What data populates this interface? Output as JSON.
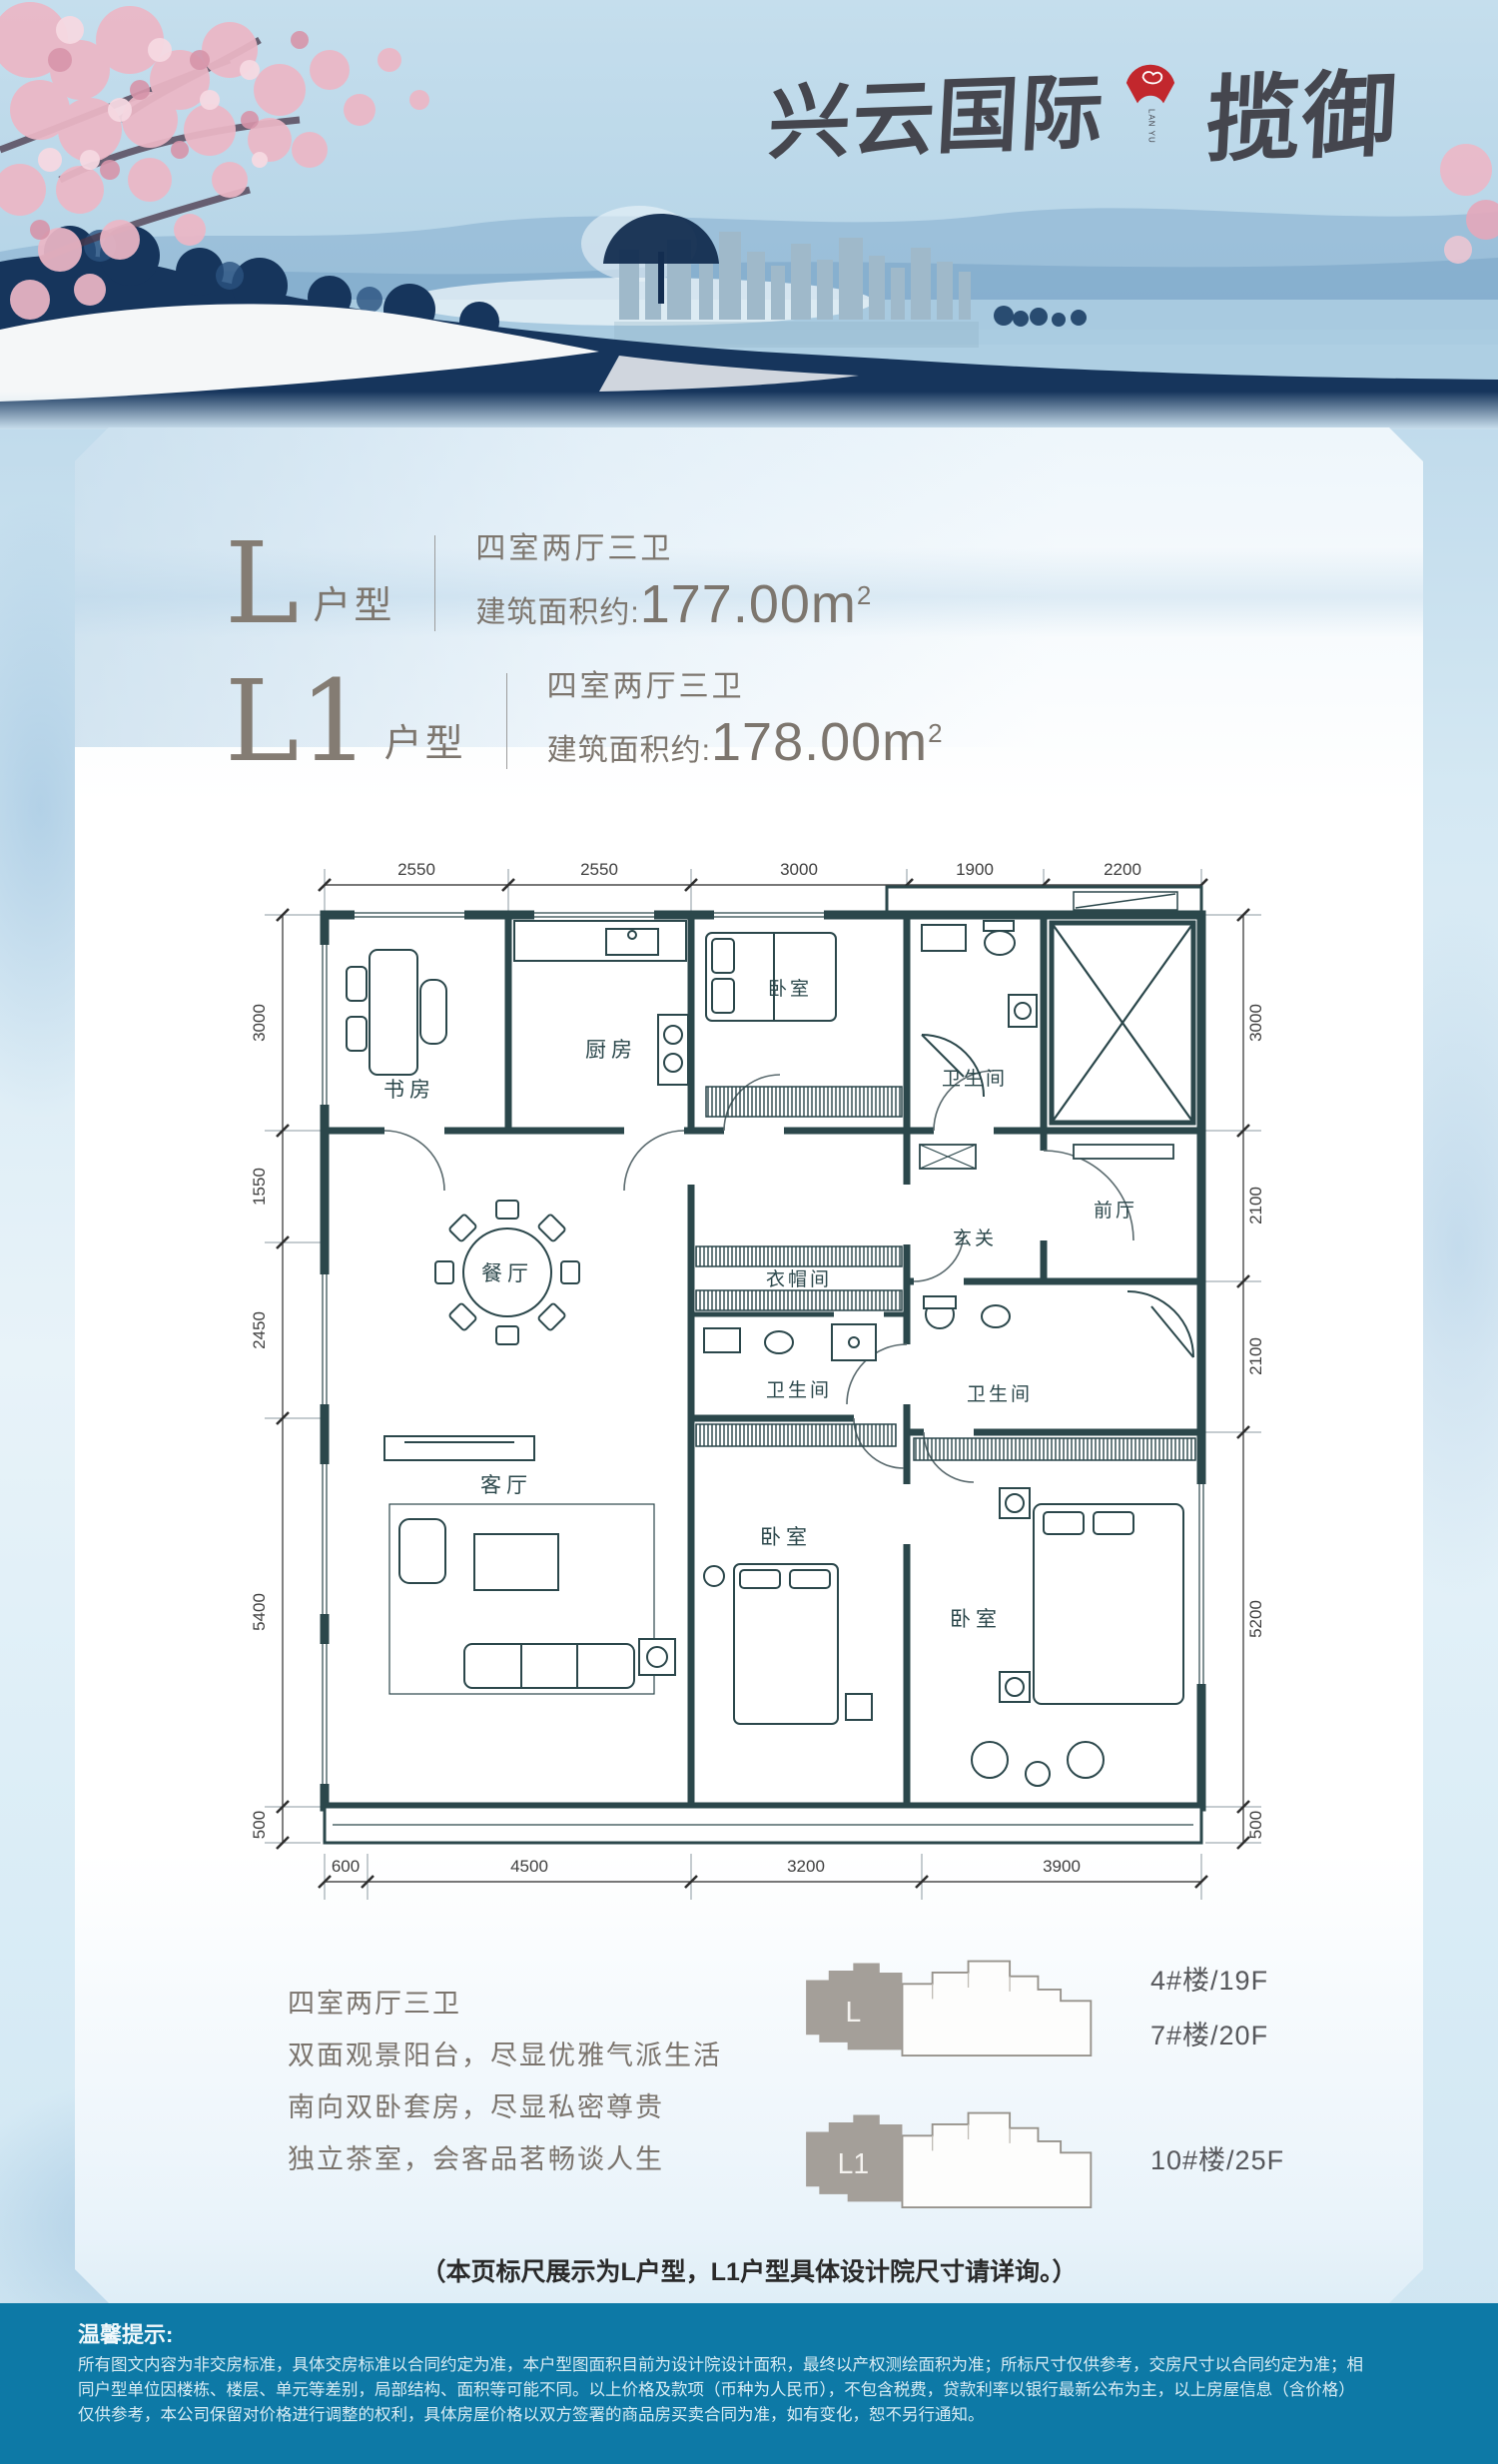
{
  "brand": {
    "name_left": "兴云国际",
    "name_right": "揽御",
    "seal_sub1": "LAN YU",
    "seal_sub2": "XINGYUNGUOJI"
  },
  "units": [
    {
      "code": "L",
      "type_suffix": "户型",
      "rooms": "四室两厅三卫",
      "area_prefix": "建筑面积约:",
      "area_value": "177.00m",
      "area_sup": "2"
    },
    {
      "code": "L1",
      "type_suffix": "户型",
      "rooms": "四室两厅三卫",
      "area_prefix": "建筑面积约:",
      "area_value": "178.00m",
      "area_sup": "2"
    }
  ],
  "floorplan": {
    "dims_top": [
      "2550",
      "2550",
      "3000",
      "1900",
      "2200"
    ],
    "dims_left": [
      "3000",
      "1550",
      "2450",
      "5400",
      "500"
    ],
    "dims_right": [
      "3000",
      "2100",
      "2100",
      "5200",
      "500"
    ],
    "dims_bottom": [
      "600",
      "4500",
      "3200",
      "3900"
    ],
    "rooms": {
      "study": "书房",
      "kitchen": "厨房",
      "bedroom_n": "卧室",
      "bath_n": "卫生间",
      "foyer": "玄关",
      "front_hall": "前厅",
      "dining": "餐厅",
      "cloak": "衣帽间",
      "bath_m": "卫生间",
      "living": "客厅",
      "bedroom_s": "卧室",
      "bedroom_e": "卧室",
      "bath_e": "卫生间"
    }
  },
  "features": [
    "四室两厅三卫",
    "双面观景阳台，尽显优雅气派生活",
    "南向双卧套房，尽显私密尊贵",
    "独立茶室，会客品茗畅谈人生"
  ],
  "buildings": [
    {
      "label": "L",
      "lines": [
        "4#楼/19F",
        "7#楼/20F"
      ]
    },
    {
      "label": "L1",
      "lines": [
        "10#楼/25F"
      ]
    }
  ],
  "note": "（本页标尺展示为L户型，L1户型具体设计院尺寸请详询。）",
  "footer": {
    "title": "温馨提示:",
    "lines": [
      "所有图文内容为非交房标准，具体交房标准以合同约定为准，本户型图面积目前为设计院设计面积，最终以产权测绘面积为准；所标尺寸仅供参考，交房尺寸以合同约定为准；相",
      "同户型单位因楼栋、楼层、单元等差别，局部结构、面积等可能不同。以上价格及款项（币种为人民币），不包含税费，贷款利率以银行最新公布为主，以上房屋信息（含价格）",
      "仅供参考，本公司保留对价格进行调整的权利，具体房屋价格以双方签署的商品房买卖合同为准，如有变化，恕不另行通知。"
    ]
  },
  "colors": {
    "wall": "#2b474b",
    "footer_bg": "#0d79a6",
    "seal_red": "#c2272d",
    "brand_ink": "#45464e",
    "warm_gray": "#7d766e"
  }
}
